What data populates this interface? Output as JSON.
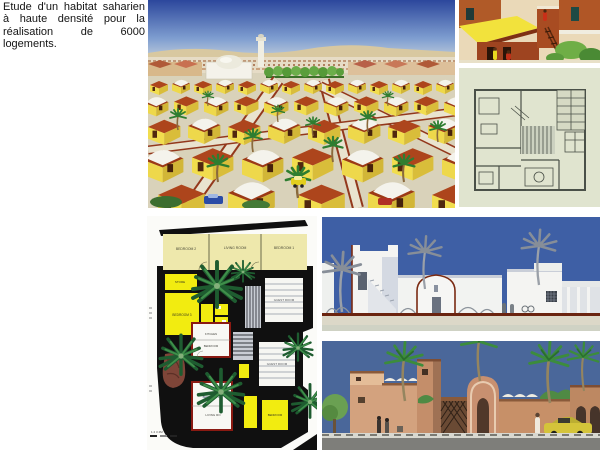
{
  "page": {
    "caption": "Etude d'un habitat saharien à haute densité pour la réalisation de 6000 logements."
  },
  "master_plan": {
    "rooms": {
      "bedroom2": "BEDROOM 2",
      "living_room": "LIVING ROOM",
      "bedroom1": "BEDROOM 1",
      "store": "STORE",
      "bedroom3": "BEDROOM 3",
      "guest_room_upper": "GUEST ROOM",
      "guest_room_lower": "GUEST ROOM",
      "kitchen": "KITCHEN",
      "bedroom_mid": "BEDROOM",
      "bedroom_low": "BEDROOM 3",
      "living_low": "LIVING RO",
      "bedroom_right": "BEDROOM"
    },
    "scale_text": "1  2  3  4M"
  },
  "colors": {
    "sky_panorama_top": "#2c479c",
    "sky_elevation_white": "#3e5fa5",
    "sky_elevation_color": "#4a679a",
    "adobe_yellow": "#f1dd4e",
    "roof_red": "#ad451c",
    "adobe_tan": "#c89070",
    "palm_green": "#2e7d30",
    "plan_yellow": "#f2ec10",
    "plan_cream": "#eee8ac",
    "plan_black": "#101010",
    "section_maroon": "#7a2a12",
    "tech_plan_bg": "#e0e4cf"
  }
}
